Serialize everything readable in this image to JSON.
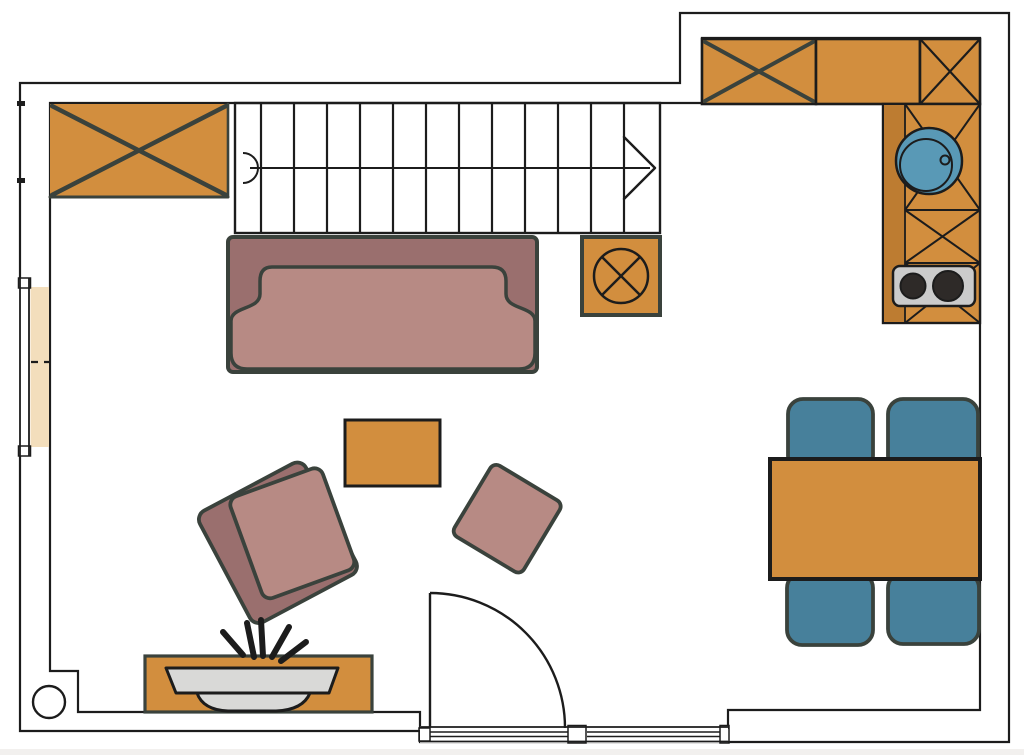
{
  "meta": {
    "title": "Apartment floor plan — open living / dining room with kitchen nook",
    "image_type": "architectural floor plan, top-down view",
    "text_labels": []
  },
  "colors": {
    "background": "#ffffff",
    "floor": "#f3debc",
    "wall": "#a9a1a0",
    "outline": "#1c1c1c",
    "sketch": "#3a423c",
    "stairs": "#d8bb8d",
    "wood": "#d28e3e",
    "wood_dark": "#bd7c31",
    "sofa_back": "#9a6f6e",
    "sofa_seat": "#b78a84",
    "chair_teal": "#47809b",
    "sink_blue": "#5999b6",
    "appliance_gray": "#cbcbcb",
    "burner": "#2e2a28",
    "plate": "#d9d9d7",
    "glass_white": "#ffffff",
    "page_edge": "#f2f0ee"
  },
  "plan": {
    "walls": {
      "shape": "L-shaped outline with stepped top-right kitchen nook",
      "openings": [
        {
          "name": "left-window",
          "wall": "left",
          "panels": 2,
          "divider": "dashed"
        },
        {
          "name": "bottom-glazed-door-opening",
          "wall": "bottom",
          "panels": 2
        },
        {
          "name": "interior-door",
          "swing": "quarter-circle arc opening inward"
        }
      ],
      "column": {
        "shape": "round",
        "location": "bottom-left corner"
      }
    },
    "staircase": {
      "location": "top center",
      "tread_lines": 12,
      "walk_line": true,
      "start_marker": "semicircle",
      "direction_arrow": "points right"
    },
    "storage": {
      "crossed_wardrobe_top_left": 1,
      "crossed_side_table_under_stairs": 1
    },
    "kitchen": {
      "upper_cabinets": [
        {
          "style": "crossed"
        },
        {
          "style": "plain"
        },
        {
          "style": "crossed-tall"
        }
      ],
      "counter_sections_crossed": 3,
      "sink": {
        "shape": "round",
        "basins": 1,
        "drain_knob": true
      },
      "stove": {
        "burners": 2
      }
    },
    "living": {
      "sofa": {
        "seats": "3-seater",
        "style": "dark back, light seat"
      },
      "armchairs": 2,
      "coffee_table": 1,
      "sideboard": {
        "decor": "plate/bowl with 5 twigs"
      }
    },
    "dining": {
      "table": 1,
      "chairs": 4,
      "chair_color": "teal"
    }
  }
}
